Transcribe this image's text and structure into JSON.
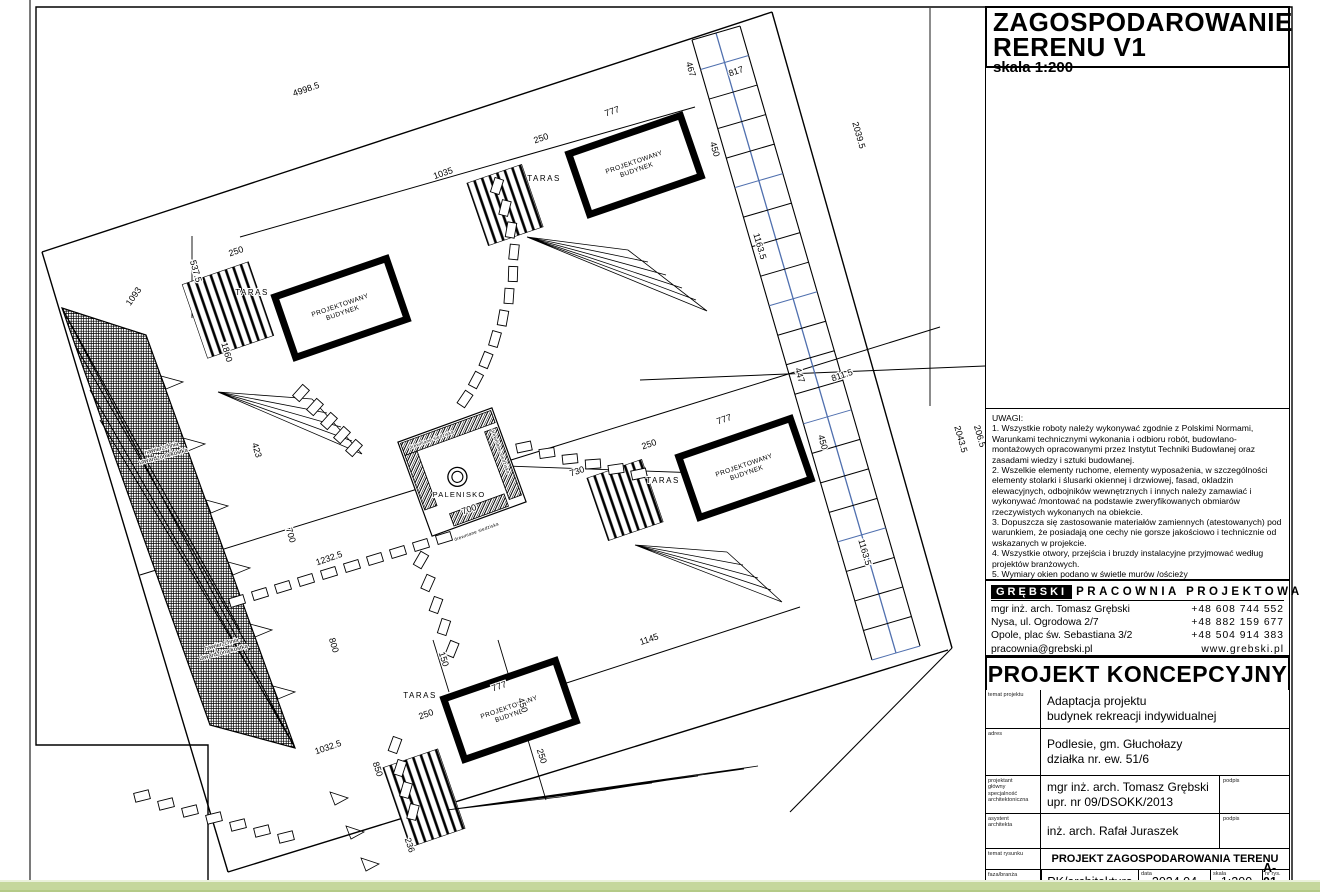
{
  "title_box": {
    "line1": "ZAGOSPODAROWANIE",
    "line2": "RERENU  V1",
    "scale": "skala 1:200"
  },
  "notes": {
    "heading": "UWAGI:",
    "items": [
      "1. Wszystkie roboty należy wykonywać zgodnie z Polskimi Normami, Warunkami technicznymi wykonania i odbioru robót,  budowlano-montażowych opracowanymi przez Instytut Techniki Budowlanej oraz zasadami wiedzy i sztuki budowlanej.",
      "2. Wszelkie elementy ruchome, elementy wyposażenia, w szczególności  elementy stolarki i ślusarki okiennej i drzwiowej, fasad, okladzin  elewacyjnych, odbojników wewnętrznych  i innych należy zamawiać i wykonywać /montować na podstawie zweryfikowanych obmiarów rzeczywistych wykonanych na obiekcie.",
      "3. Dopuszcza się zastosowanie materiałów zamiennych (atestowanych) pod warunkiem,  że posiadają one cechy nie gorsze jakościowo i technicznie od wskazanych w projekcie.",
      "4. Wszystkie otwory, przejścia  i bruzdy instalacyjne przyjmować według projektów branżowych.",
      "5. Wymiary okien podano w świetle murów /ościeży"
    ]
  },
  "studio": {
    "brand": "GRĘBSKI",
    "brand_rest": "PRACOWNIA PROJEKTOWA",
    "rows": [
      {
        "left": "mgr inż. arch. Tomasz Grębski",
        "right": "+48 608 744 552"
      },
      {
        "left": "Nysa, ul. Ogrodowa 2/7",
        "right": "+48 882 159 677"
      },
      {
        "left": "Opole, plac św. Sebastiana 3/2",
        "right": "+48 504 914 383"
      },
      {
        "left": "pracownia@grebski.pl",
        "right": "www.grebski.pl"
      }
    ]
  },
  "project_type": "PROJEKT KONCEPCYJNY",
  "titleblock": {
    "temat": {
      "label": "temat projektu",
      "line1": "Adaptacja projektu",
      "line2": "budynek rekreacji indywidualnej"
    },
    "adres": {
      "label": "adres",
      "line1": "Podlesie, gm. Głuchołazy",
      "line2": "działka nr. ew. 51/6"
    },
    "projektant": {
      "label1": "projektant",
      "label2": "główny",
      "label3": "specjalność",
      "label4": "architektoniczna",
      "line1": "mgr inż. arch. Tomasz Grębski",
      "line2": "upr. nr 09/DSOKK/2013",
      "podpis": "podpis"
    },
    "asystent": {
      "label1": "asystent",
      "label2": "architekta",
      "line1": "inż. arch. Rafał Juraszek",
      "podpis": "podpis"
    },
    "rysunek": {
      "label": "temat rysunku",
      "title": "PROJEKT ZAGOSPODAROWANIA TERENU"
    },
    "meta": {
      "label": "faza/branża",
      "phase": "PK/architektura",
      "date_label": "data",
      "date": "2024.04",
      "scale_label": "skala",
      "scale": "1:200",
      "sheet_label": "nr rys.",
      "sheet": "A-01"
    }
  },
  "drawing": {
    "building_label1": "PROJEKTOWANY",
    "building_label2": "BUDYNEK",
    "buildings": [
      {
        "x": 635,
        "y": 165
      },
      {
        "x": 341,
        "y": 308
      },
      {
        "x": 745,
        "y": 468
      },
      {
        "x": 510,
        "y": 710
      }
    ],
    "taras_label": "TARAS",
    "palenisko_label": "PALENISKO",
    "bench_label": "drewniane siedziska",
    "surface_label_line1": "nawierzchnia",
    "surface_label_line2": "utwardzona/kostka",
    "colors": {
      "line": "#000000",
      "parking_blue": "#4f6fae",
      "green_bar": "#c5d79c"
    },
    "dimensions": [
      {
        "t": "4998.5",
        "x": 307,
        "y": 92,
        "r": -19
      },
      {
        "t": "1035",
        "x": 444,
        "y": 176,
        "r": -19
      },
      {
        "t": "537.5",
        "x": 193,
        "y": 272,
        "r": 74
      },
      {
        "t": "1093",
        "x": 136,
        "y": 298,
        "r": -55
      },
      {
        "t": "250",
        "x": 237,
        "y": 254,
        "r": -19
      },
      {
        "t": "467",
        "x": 688,
        "y": 70,
        "r": 74
      },
      {
        "t": "817",
        "x": 737,
        "y": 74,
        "r": -19
      },
      {
        "t": "450",
        "x": 712,
        "y": 150,
        "r": 74
      },
      {
        "t": "2039.5",
        "x": 856,
        "y": 136,
        "r": 74
      },
      {
        "t": "1163.5",
        "x": 757,
        "y": 247,
        "r": 74
      },
      {
        "t": "777",
        "x": 613,
        "y": 114,
        "r": -19
      },
      {
        "t": "250",
        "x": 542,
        "y": 141,
        "r": -19
      },
      {
        "t": "450",
        "x": 820,
        "y": 443,
        "r": 74
      },
      {
        "t": "447",
        "x": 797,
        "y": 376,
        "r": 74
      },
      {
        "t": "811.5",
        "x": 843,
        "y": 378,
        "r": -19
      },
      {
        "t": "2043.5",
        "x": 958,
        "y": 440,
        "r": 74
      },
      {
        "t": "1163.5",
        "x": 862,
        "y": 553,
        "r": 74
      },
      {
        "t": "206.5",
        "x": 977,
        "y": 437,
        "r": 74
      },
      {
        "t": "777",
        "x": 725,
        "y": 422,
        "r": -19
      },
      {
        "t": "250",
        "x": 650,
        "y": 447,
        "r": -19
      },
      {
        "t": "730",
        "x": 578,
        "y": 474,
        "r": -19
      },
      {
        "t": "700",
        "x": 470,
        "y": 512,
        "r": -19
      },
      {
        "t": "1860",
        "x": 224,
        "y": 353,
        "r": 74
      },
      {
        "t": "423",
        "x": 254,
        "y": 451,
        "r": 74
      },
      {
        "t": "700",
        "x": 288,
        "y": 536,
        "r": 74
      },
      {
        "t": "1232.5",
        "x": 330,
        "y": 561,
        "r": -19
      },
      {
        "t": "800",
        "x": 331,
        "y": 646,
        "r": 74
      },
      {
        "t": "1145",
        "x": 650,
        "y": 642,
        "r": -19
      },
      {
        "t": "1032.5",
        "x": 329,
        "y": 750,
        "r": -19
      },
      {
        "t": "850",
        "x": 375,
        "y": 770,
        "r": 72
      },
      {
        "t": "236",
        "x": 407,
        "y": 846,
        "r": 72
      },
      {
        "t": "777",
        "x": 500,
        "y": 689,
        "r": -19
      },
      {
        "t": "150",
        "x": 441,
        "y": 660,
        "r": 72
      },
      {
        "t": "450",
        "x": 520,
        "y": 706,
        "r": 72
      },
      {
        "t": "250",
        "x": 427,
        "y": 717,
        "r": -19
      },
      {
        "t": "250",
        "x": 539,
        "y": 757,
        "r": 72
      }
    ]
  }
}
